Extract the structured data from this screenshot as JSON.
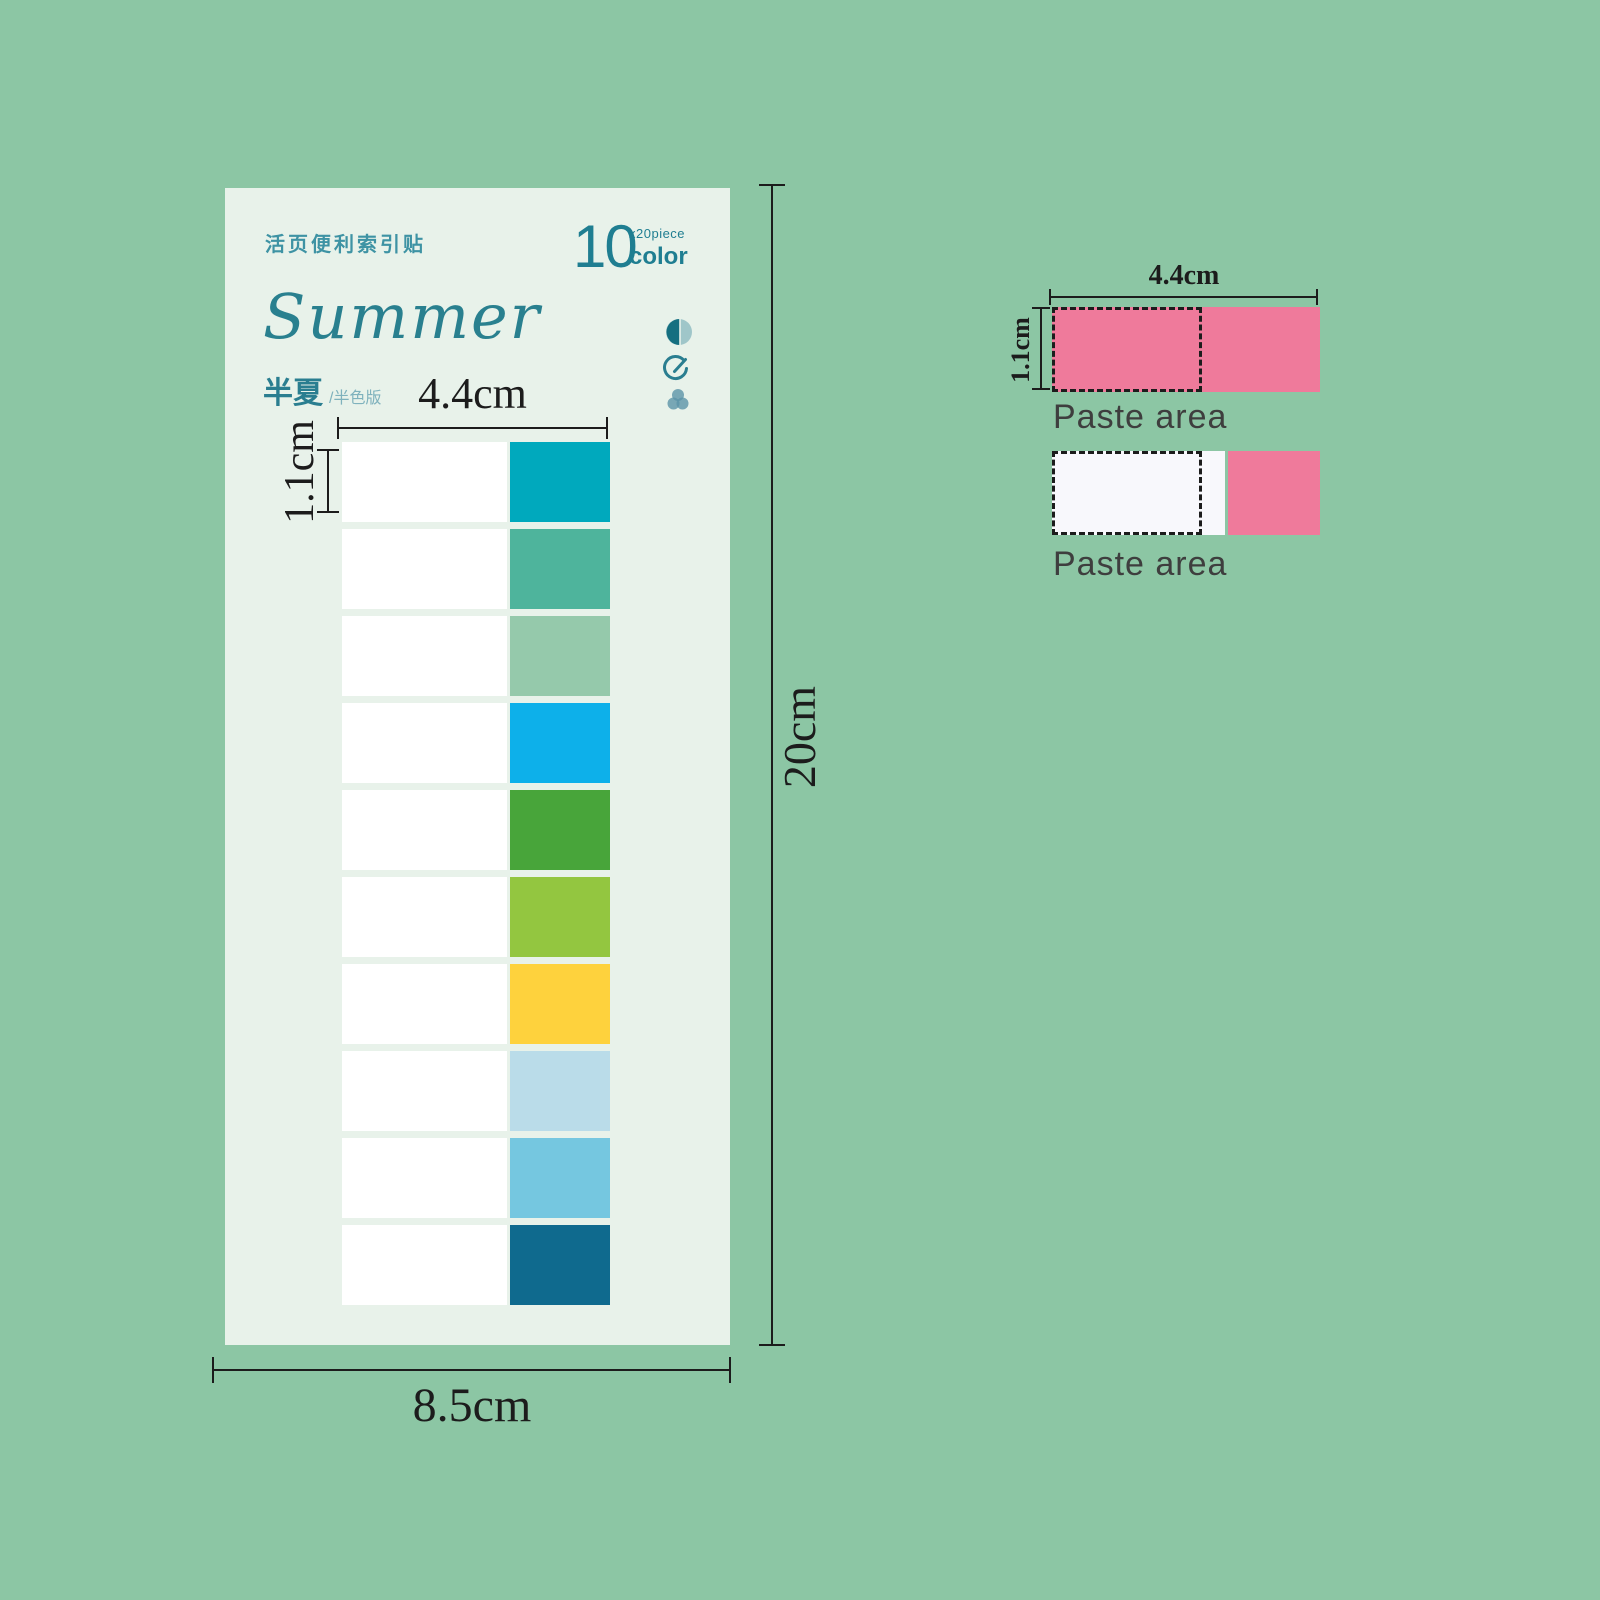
{
  "background_color": "#8cc6a4",
  "card": {
    "bg_color": "#e8f2ea",
    "header_label_cn": "活页便利索引贴",
    "count": {
      "number": "10",
      "pieces": "x20piece",
      "unit": "color"
    },
    "title": "Summer",
    "subtitle_cn": "半夏",
    "subtitle_suffix": "/半色版",
    "accent_color": "#1f7e91",
    "tab_width_label": "4.4cm",
    "tab_height_label": "1.1cm",
    "card_width_label": "8.5cm",
    "card_height_label": "20cm",
    "tabs": {
      "rows": 10,
      "white_part_color": "#ffffff",
      "colors": [
        "#00a9bd",
        "#4eb49c",
        "#95c9ab",
        "#0db0ea",
        "#48a53a",
        "#93c640",
        "#fed23d",
        "#badce9",
        "#75c7e0",
        "#0f6a8e"
      ]
    }
  },
  "paste_diagram": {
    "width_label": "4.4cm",
    "height_label": "1.1cm",
    "top_label": "Paste area",
    "bottom_label": "Paste area",
    "pink_color": "#ef7a9b",
    "back_color": "#f8f8fc"
  }
}
